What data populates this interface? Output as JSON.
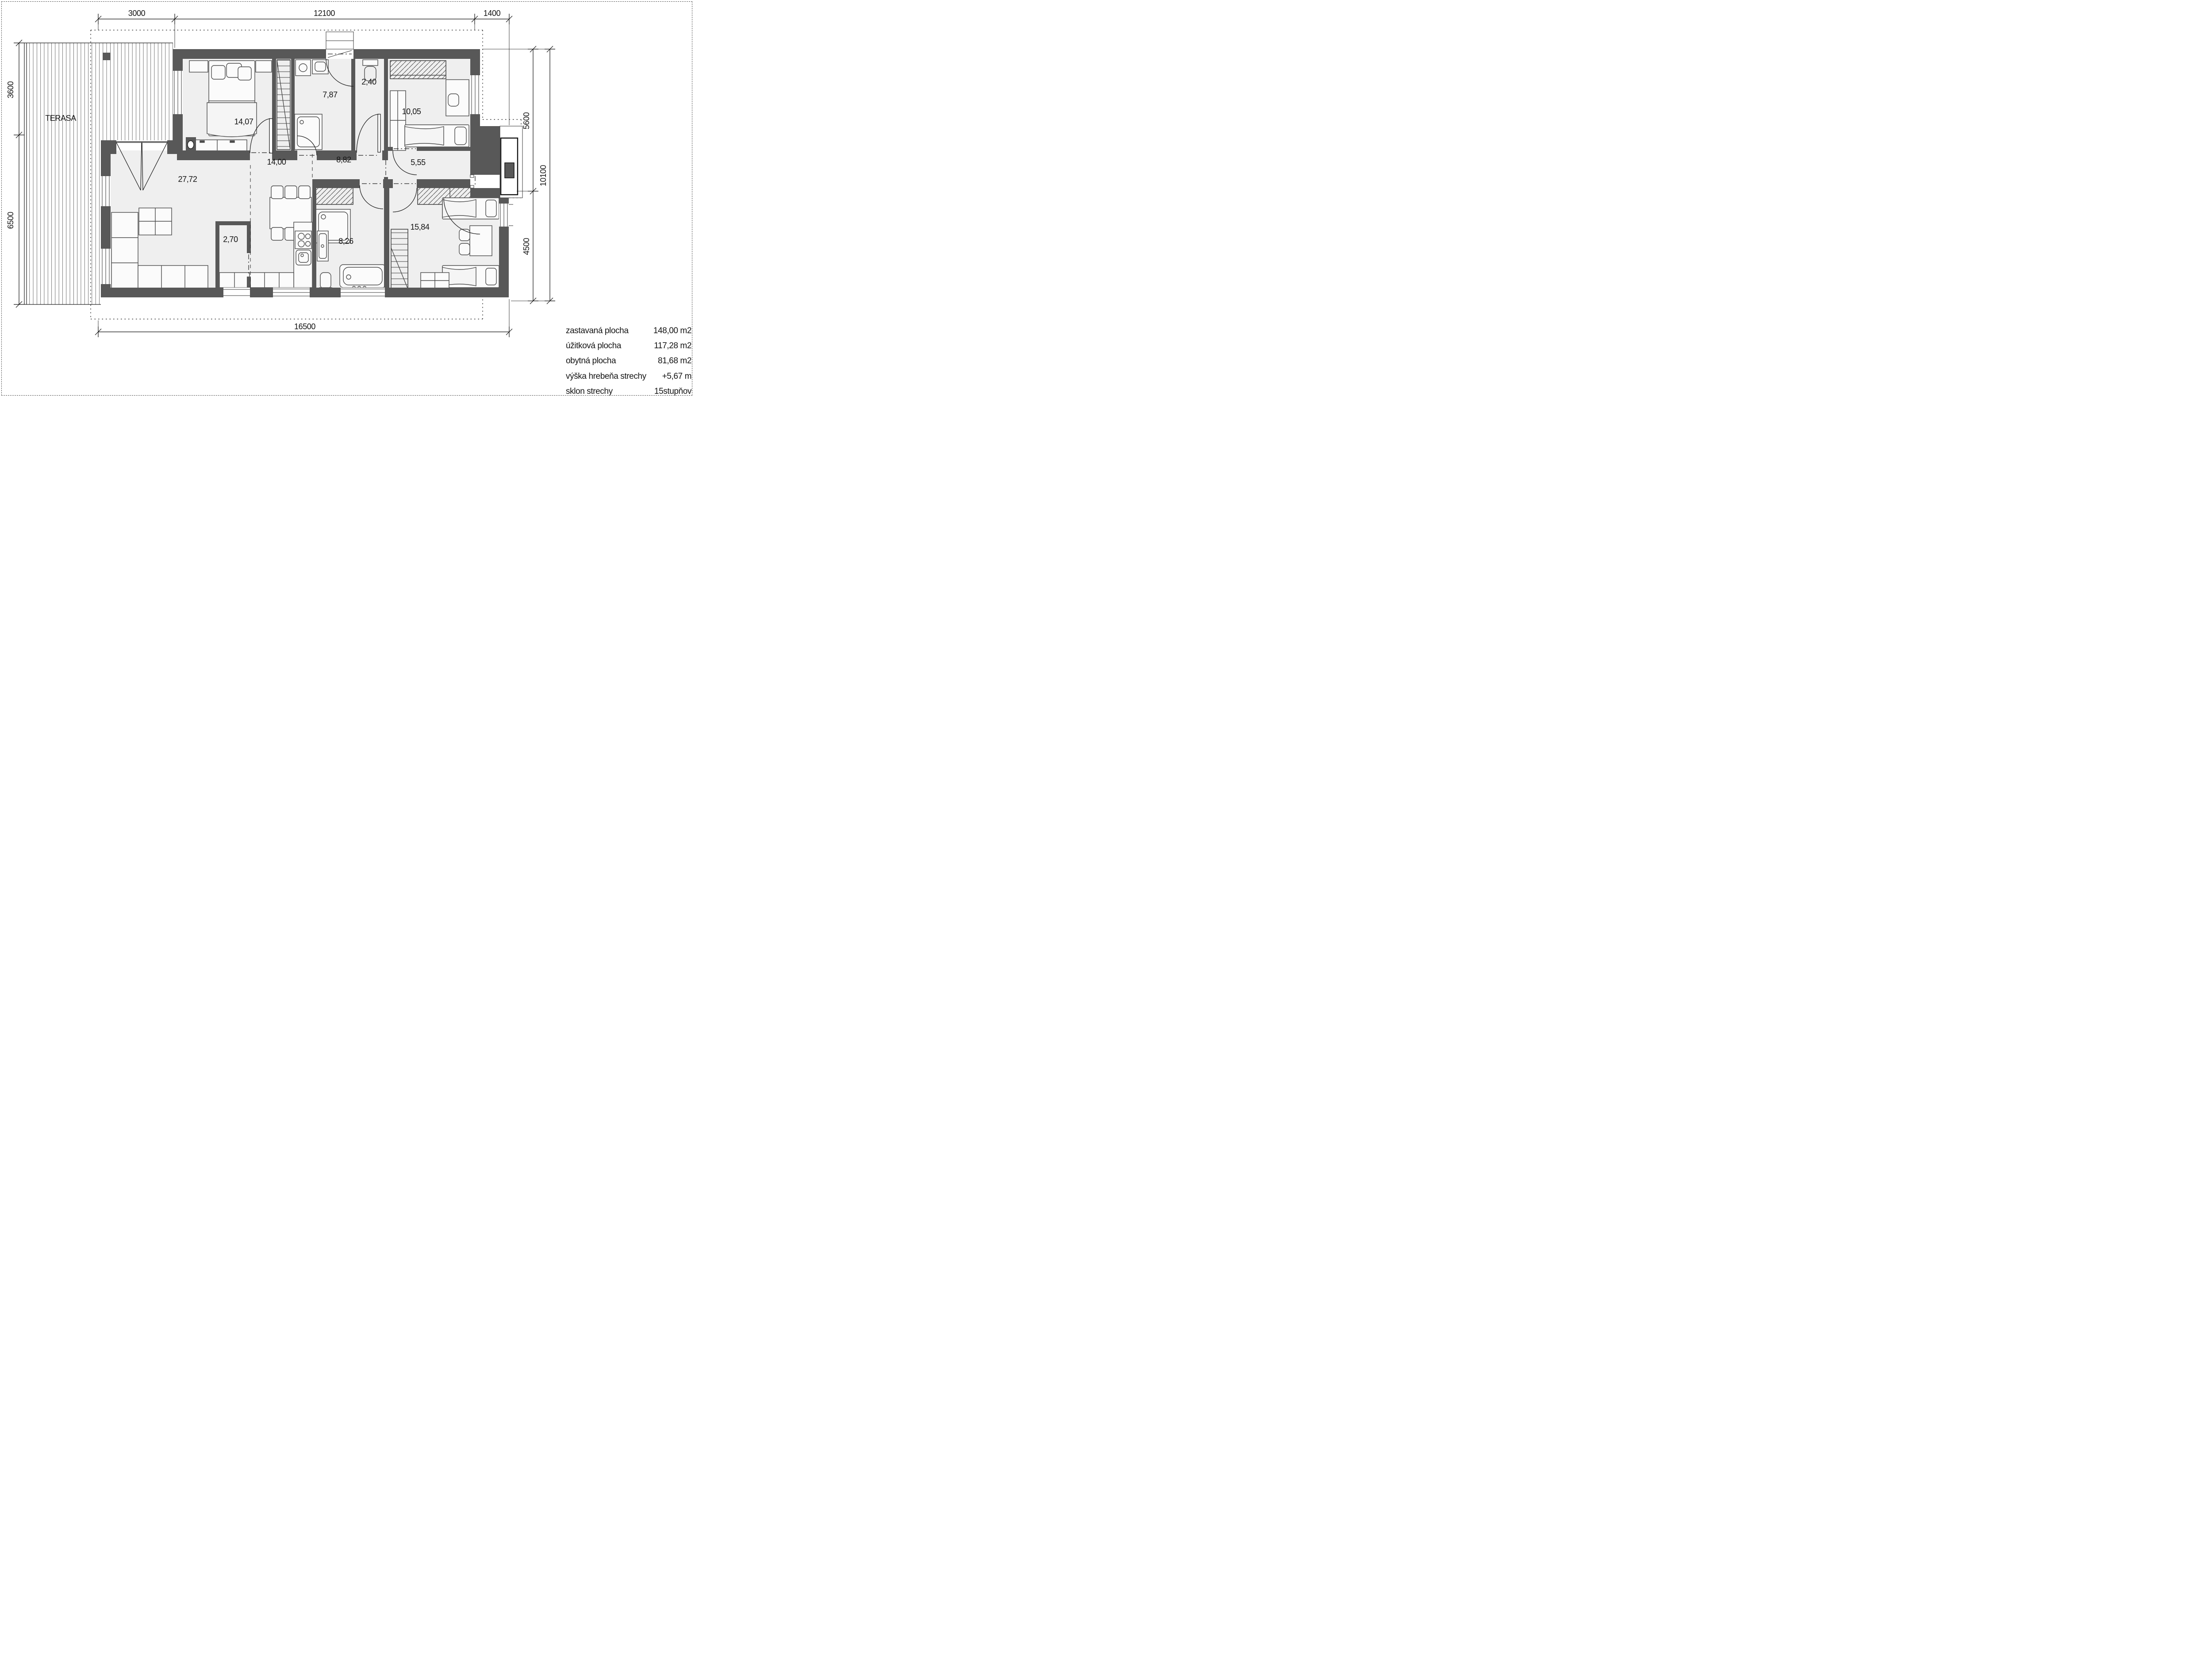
{
  "plan": {
    "terrace_label": "TERASA",
    "rooms": [
      {
        "id": "bedroom-1",
        "area": "14,07"
      },
      {
        "id": "bathroom-1",
        "area": "7,87"
      },
      {
        "id": "wc",
        "area": "2,40"
      },
      {
        "id": "bedroom-2",
        "area": "10,05"
      },
      {
        "id": "hallway",
        "area": "14,00"
      },
      {
        "id": "hall",
        "area": "8,82"
      },
      {
        "id": "entry",
        "area": "5,55"
      },
      {
        "id": "living-kitchen",
        "area": "27,72"
      },
      {
        "id": "pantry",
        "area": "2,70"
      },
      {
        "id": "bathroom-2",
        "area": "8,26"
      },
      {
        "id": "bedroom-3",
        "area": "15,84"
      }
    ],
    "dimensions": {
      "top": [
        "3000",
        "12100",
        "1400"
      ],
      "left": [
        "3600",
        "6500"
      ],
      "right": [
        "5600",
        "4500",
        "10100"
      ],
      "bottom": [
        "16500"
      ]
    },
    "colors": {
      "wall": "#585858",
      "floor": "#efefef",
      "line": "#1a1a1a"
    }
  },
  "summary": {
    "rows": [
      {
        "label": "zastavaná plocha",
        "value": "148,00 m2"
      },
      {
        "label": "úžitková plocha",
        "value": "117,28 m2"
      },
      {
        "label": "obytná plocha",
        "value": "81,68 m2"
      },
      {
        "label": "výška hrebeňa strechy",
        "value": "+5,67 m"
      },
      {
        "label": "sklon strechy",
        "value": "15stupňov"
      }
    ]
  }
}
